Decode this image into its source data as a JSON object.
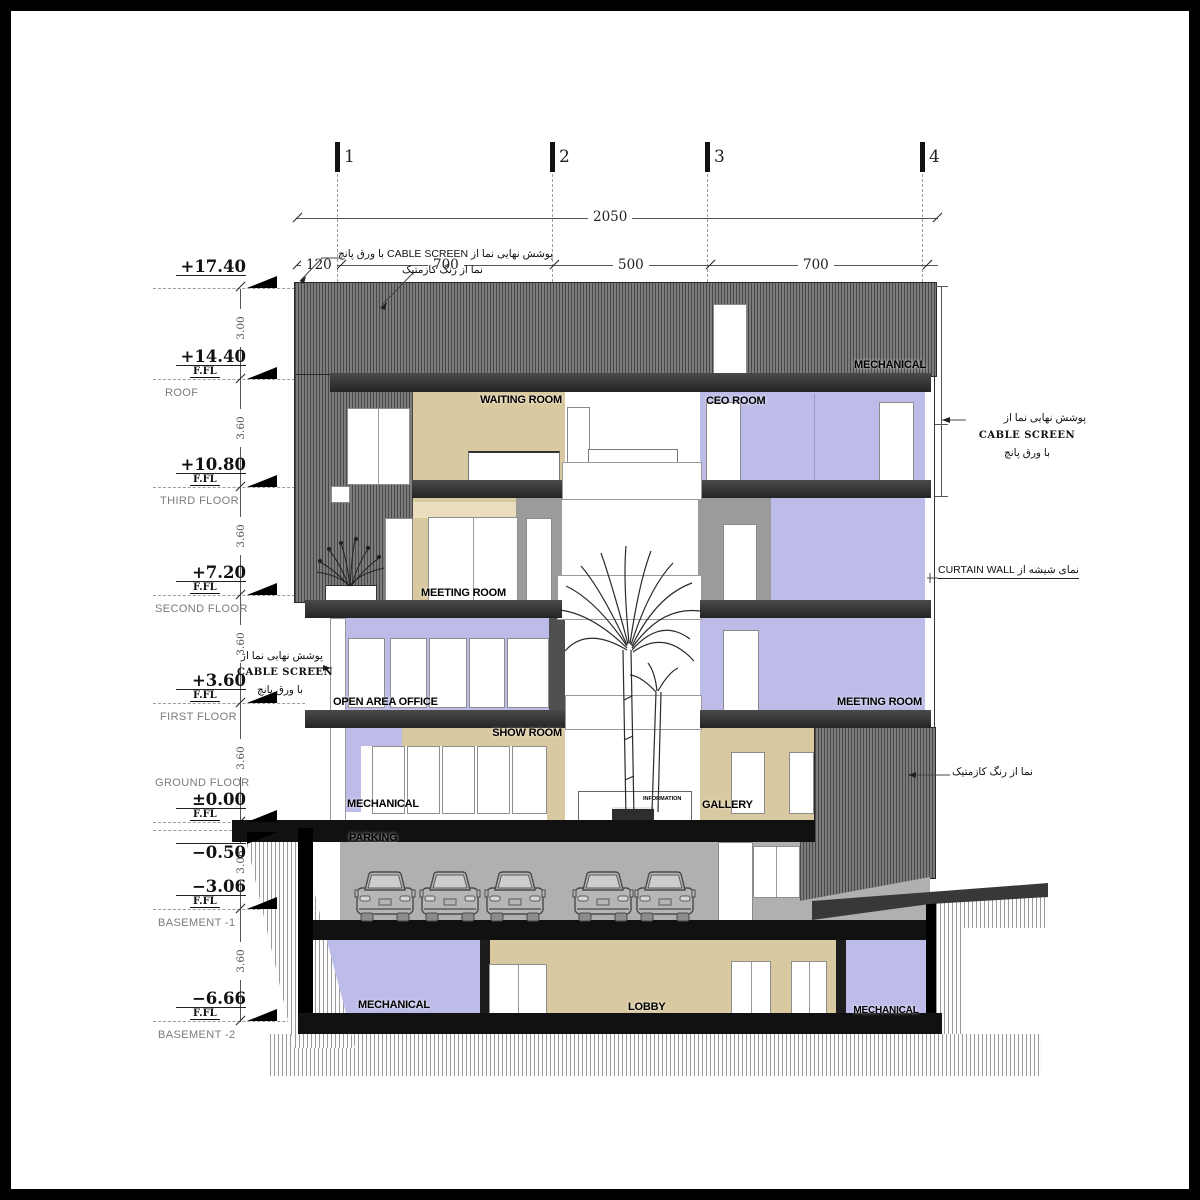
{
  "grid": {
    "axes": [
      "1",
      "2",
      "3",
      "4"
    ],
    "dim_total": "2050",
    "dim_segments": [
      "120",
      "700",
      "500",
      "700"
    ]
  },
  "elevations": [
    {
      "value": "+17.40",
      "ffl": "",
      "floor": ""
    },
    {
      "value": "+14.40",
      "ffl": "F.FL",
      "floor": "ROOF"
    },
    {
      "value": "+10.80",
      "ffl": "F.FL",
      "floor": "THIRD FLOOR"
    },
    {
      "value": "+7.20",
      "ffl": "F.FL",
      "floor": "SECOND FLOOR"
    },
    {
      "value": "+3.60",
      "ffl": "F.FL",
      "floor": "FIRST FLOOR"
    },
    {
      "value": "±0.00",
      "ffl": "F.FL",
      "floor": "GROUND FLOOR"
    },
    {
      "value": "−0.50",
      "ffl": "",
      "floor": ""
    },
    {
      "value": "−3.06",
      "ffl": "F.FL",
      "floor": "BASEMENT -1"
    },
    {
      "value": "−6.66",
      "ffl": "F.FL",
      "floor": "BASEMENT -2"
    }
  ],
  "floor_heights": [
    "3.00",
    "3.60",
    "3.60",
    "3.60",
    "3.60",
    "3.06",
    "3.60"
  ],
  "rooms": {
    "mechanical_roof": "MECHANICAL",
    "waiting_room": "WAITING ROOM",
    "ceo_room": "CEO ROOM",
    "meeting_room_2f": "MEETING ROOM",
    "open_area_office": "OPEN AREA OFFICE",
    "meeting_room_1f": "MEETING ROOM",
    "show_room": "SHOW ROOM",
    "mechanical_gf": "MECHANICAL",
    "information": "INFORMATION",
    "gallery": "GALLERY",
    "parking": "PARKING",
    "mechanical_b2_left": "MECHANICAL",
    "lobby": "LOBBY",
    "mechanical_b2_right": "MECHANICAL"
  },
  "annotations": {
    "top_cable": "پوشش نهایی نما از CABLE SCREEN با ورق پانچ",
    "top_paint": "نما از رنگ کازمتیک",
    "cable_line1": "پوشش نهایی نما از",
    "cable_line2": "CABLE SCREEN",
    "cable_line3": "با ورق پانچ",
    "curtain_wall": "نمای شیشه از CURTAIN WALL",
    "right_paint": "نما از رنگ کازمتیک"
  },
  "colors": {
    "room_purple": "#bdbce8",
    "room_tan": "#d9c9a0",
    "facade_hatch": "#6f6f6f",
    "slab_dark": "#2f2f2f",
    "parking_gray": "#b0b0b0"
  }
}
